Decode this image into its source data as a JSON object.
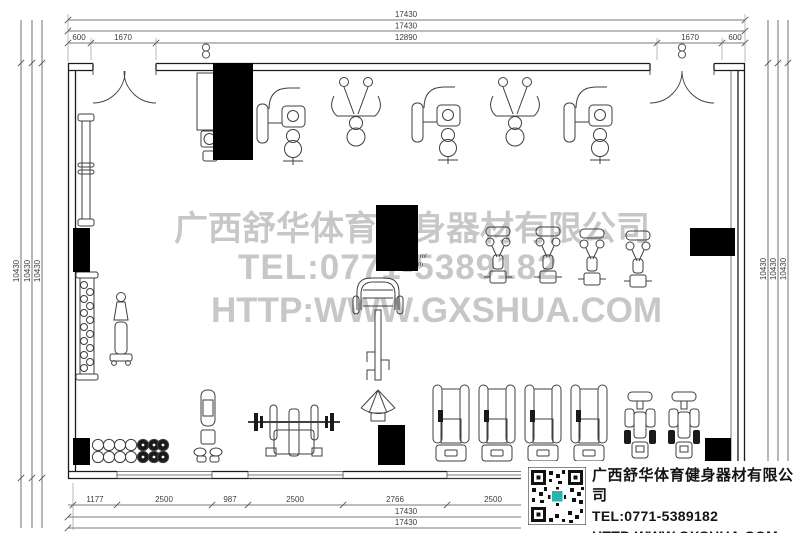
{
  "drawing": {
    "watermark": {
      "company": "广西舒华体育健身器材有限公司",
      "tel": "TEL:0771-5389182",
      "url": "HTTP:WWW.GXSHUA.COM"
    },
    "area_label": {
      "sup": "m²",
      "sub": "m"
    },
    "dimensions": {
      "top": [
        "17430",
        "17430"
      ],
      "top_segments": [
        "600",
        "1670",
        "12890",
        "1670",
        "600"
      ],
      "left": [
        "10430",
        "10430",
        "10430"
      ],
      "right": [
        "10430",
        "10430",
        "10430"
      ],
      "bottom_segments": [
        "1177",
        "2500",
        "987",
        "2500",
        "2766",
        "2500"
      ],
      "bottom": [
        "17430",
        "17430"
      ]
    }
  },
  "info_block": {
    "company": "广西舒华体育健身器材有限公司",
    "tel": "TEL:0771-5389182",
    "url": "HTTP:WWW.GXSHUA.COM"
  },
  "colors": {
    "line": "#3f3f3f",
    "dim": "#4c4c4c",
    "watermark": "#c7c7c7",
    "column": "#000000",
    "qr_accent": "#2bb3ae"
  }
}
